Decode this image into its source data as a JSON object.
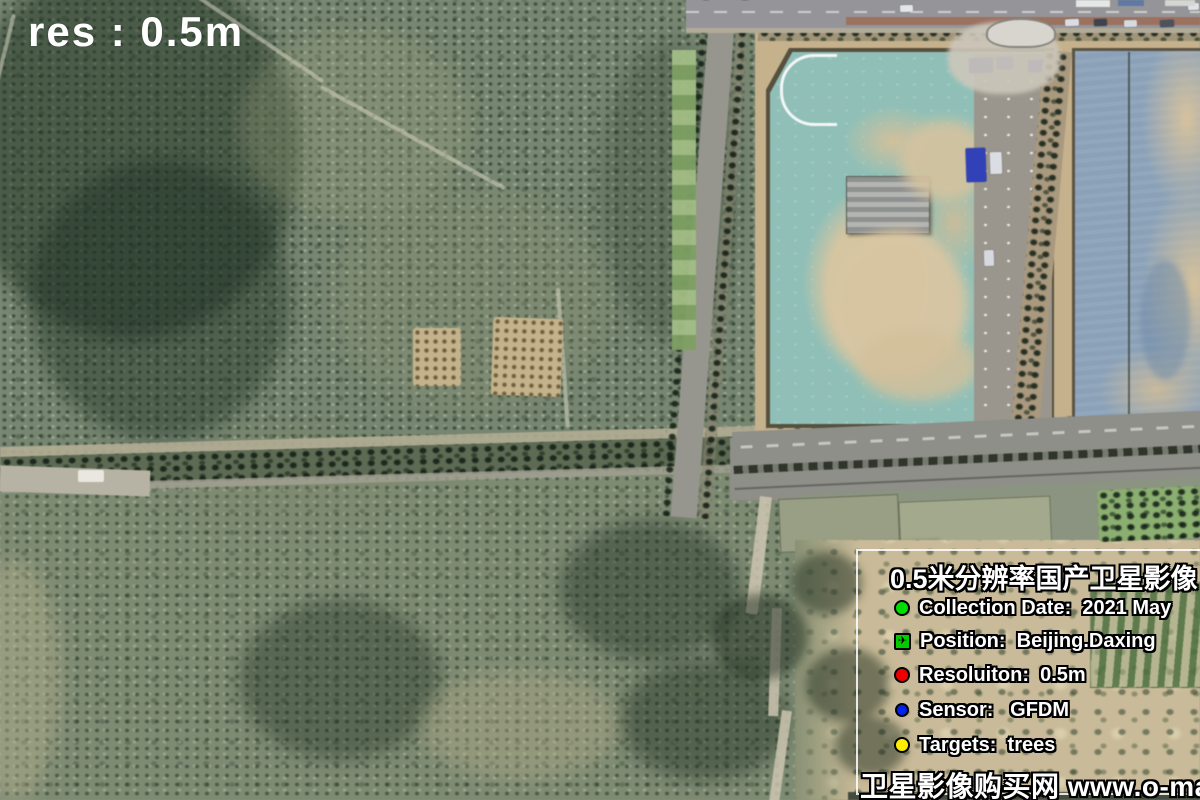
{
  "map_overlay": {
    "resolution_label": "res : 0.5m"
  },
  "info_box": {
    "title": "0.5米分辨率国产卫星影像",
    "items": [
      {
        "icon": "collection-date-dot-icon",
        "shape": "circle",
        "color": "#00dd00",
        "label": "Collection Date:  2021 May"
      },
      {
        "icon": "position-plane-icon",
        "shape": "square",
        "color": "#00cc00",
        "label": "Position:  Beijing.Daxing"
      },
      {
        "icon": "resolution-dot-icon",
        "shape": "circle",
        "color": "#ee0000",
        "label": "Resoluiton:  0.5m"
      },
      {
        "icon": "sensor-dot-icon",
        "shape": "circle",
        "color": "#0022ee",
        "label": "Sensor:   GFDM"
      },
      {
        "icon": "targets-dot-icon",
        "shape": "circle",
        "color": "#ffee00",
        "label": "Targets:  trees"
      }
    ],
    "footer": "卫星影像购买网 www.o-map.cn"
  }
}
